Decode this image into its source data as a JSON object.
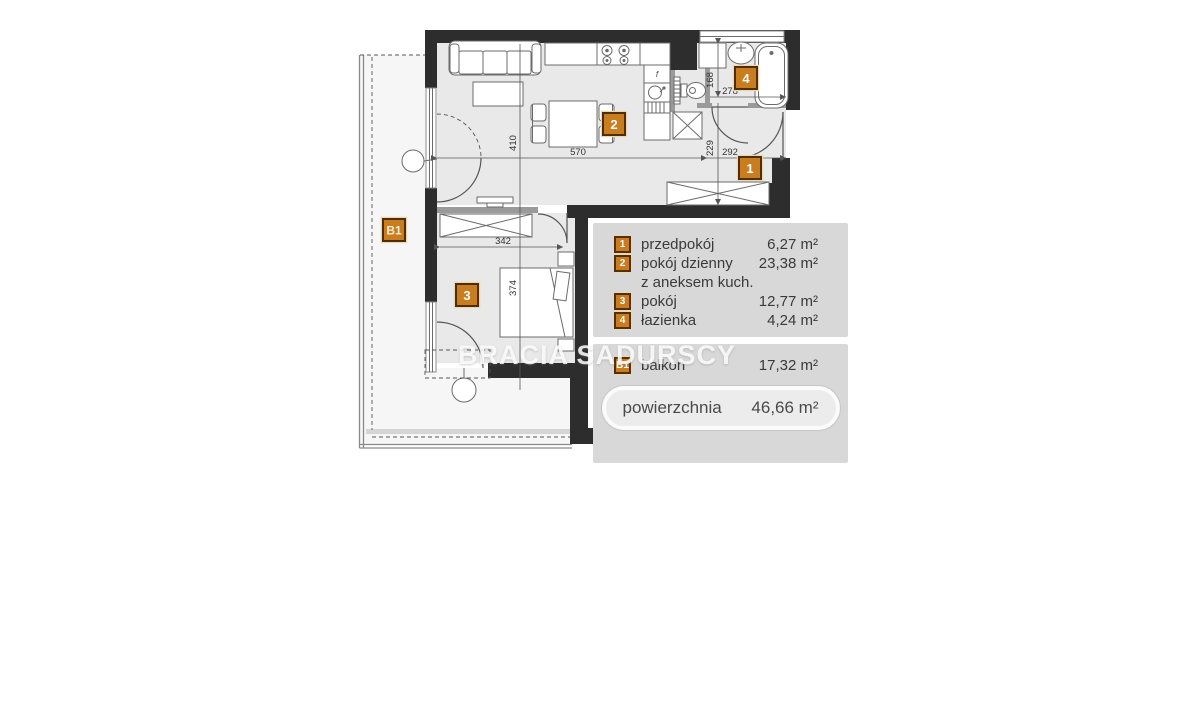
{
  "watermark": "BRACIA SADURSCY",
  "plan": {
    "badges": {
      "hall": "1",
      "living": "2",
      "bedroom": "3",
      "bath": "4",
      "balcony": "B1"
    },
    "dims": {
      "living_h": "410",
      "living_w": "570",
      "hall_w": "292",
      "hall_h": "229",
      "bath_h": "168",
      "bath_w": "278",
      "bedroom_w": "342",
      "bedroom_h": "374"
    },
    "fridge_label": "f"
  },
  "legend": {
    "rows": [
      {
        "badge": "1",
        "label": "przedpokój",
        "area": "6,27 m²"
      },
      {
        "badge": "2",
        "label": "pokój dzienny",
        "area": "23,38 m²"
      },
      {
        "badge": "",
        "label": "z aneksem kuch.",
        "area": ""
      },
      {
        "badge": "3",
        "label": "pokój",
        "area": "12,77 m²"
      },
      {
        "badge": "4",
        "label": "łazienka",
        "area": "4,24 m²"
      }
    ],
    "balcony_row": {
      "badge": "B1",
      "label": "balkon",
      "area": "17,32 m²"
    },
    "total": {
      "label": "powierzchnia",
      "value": "46,66 m²"
    }
  },
  "colors": {
    "accent": "#c97d1f",
    "wall": "#2d2d2d",
    "panel": "#d8d8d8"
  }
}
